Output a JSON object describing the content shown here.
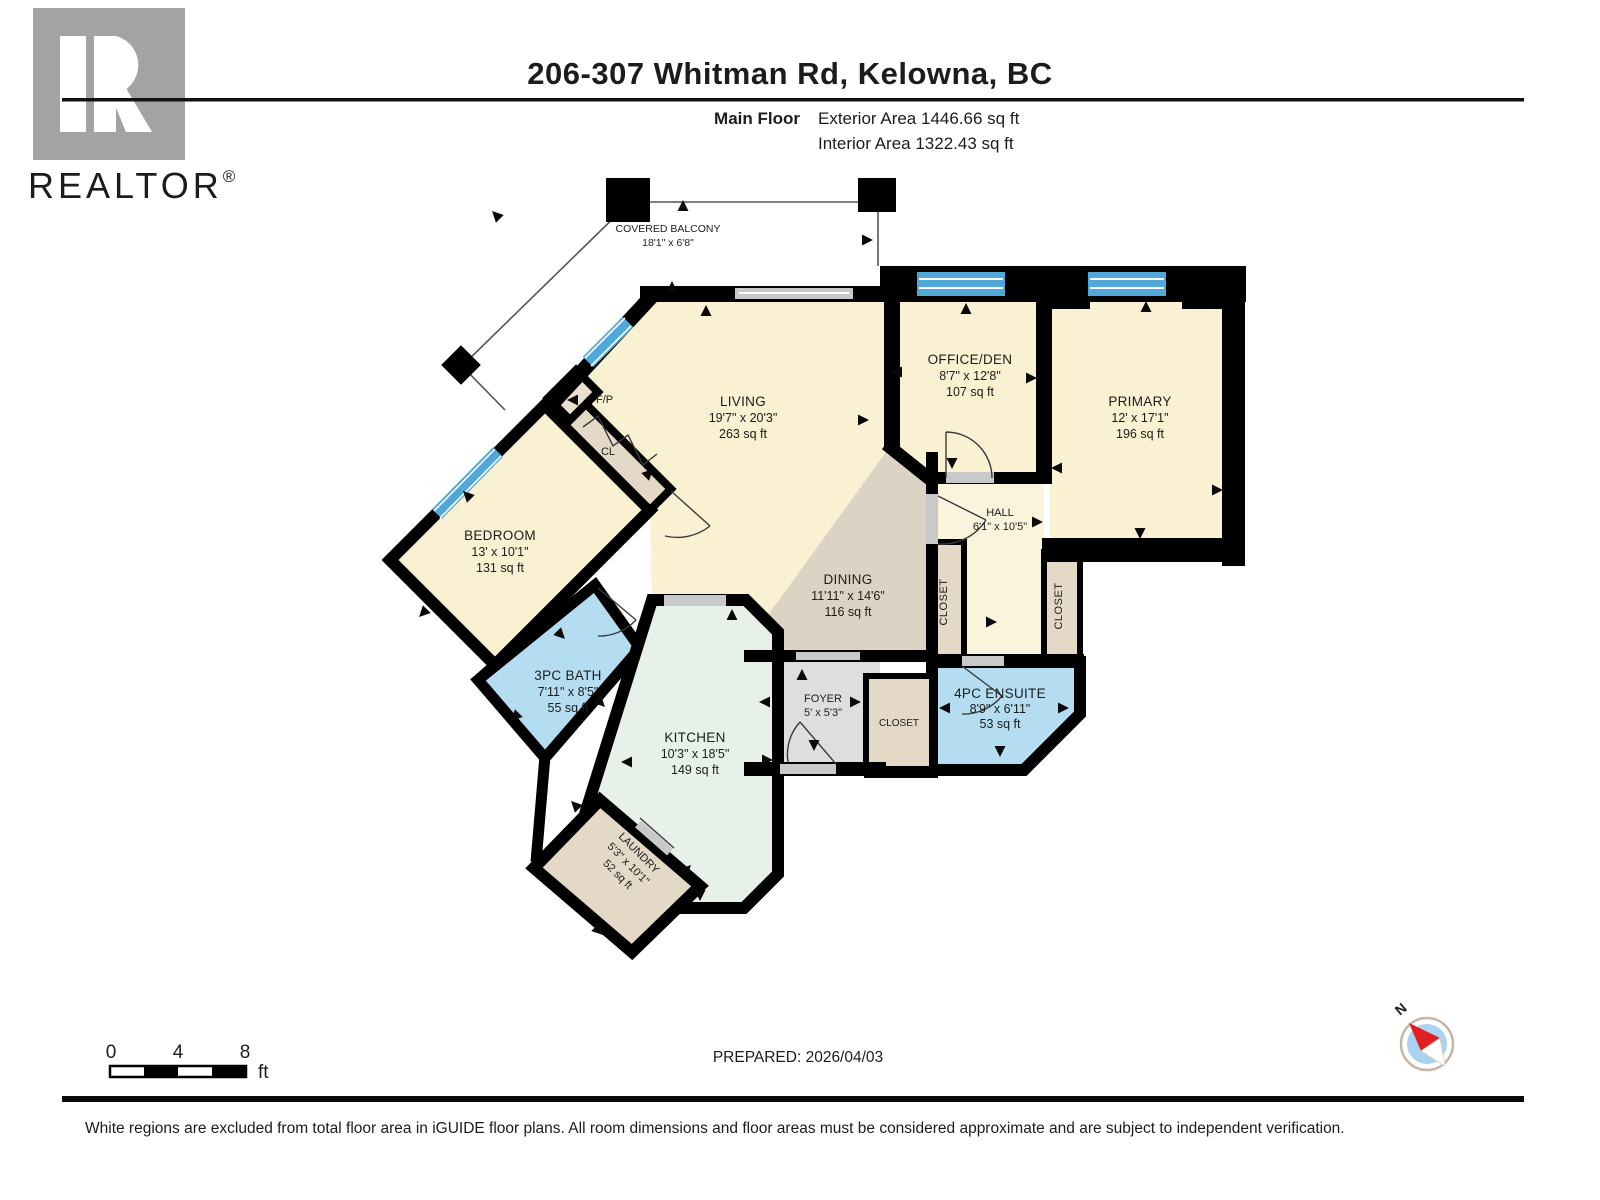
{
  "header": {
    "title": "206-307 Whitman Rd, Kelowna, BC",
    "floor_label": "Main Floor",
    "exterior_area": "Exterior Area 1446.66 sq ft",
    "interior_area": "Interior Area 1322.43 sq ft"
  },
  "branding": {
    "logo_letter": "R",
    "logo_word": "REALTOR",
    "registered_mark": "®"
  },
  "rooms": {
    "covered_balcony": {
      "name": "COVERED BALCONY",
      "dims": "18'1\" x 6'8\""
    },
    "living": {
      "name": "LIVING",
      "dims": "19'7\" x 20'3\"",
      "area": "263 sq ft"
    },
    "office_den": {
      "name": "OFFICE/DEN",
      "dims": "8'7\" x 12'8\"",
      "area": "107 sq ft"
    },
    "primary": {
      "name": "PRIMARY",
      "dims": "12' x 17'1\"",
      "area": "196 sq ft"
    },
    "bedroom": {
      "name": "BEDROOM",
      "dims": "13' x 10'1\"",
      "area": "131 sq ft"
    },
    "dining": {
      "name": "DINING",
      "dims": "11'11\" x 14'6\"",
      "area": "116 sq ft"
    },
    "kitchen": {
      "name": "KITCHEN",
      "dims": "10'3\" x 18'5\"",
      "area": "149 sq ft"
    },
    "bath_3pc": {
      "name": "3PC BATH",
      "dims": "7'11\" x 8'5\"",
      "area": "55 sq ft"
    },
    "ensuite_4pc": {
      "name": "4PC ENSUITE",
      "dims": "8'9\" x 6'11\"",
      "area": "53 sq ft"
    },
    "laundry": {
      "name": "LAUNDRY",
      "dims": "5'3\" x 10'1\"",
      "area": "52 sq ft"
    },
    "foyer": {
      "name": "FOYER",
      "dims": "5' x 5'3\""
    },
    "hall": {
      "name": "HALL",
      "dims": "6'1\" x 10'5\""
    },
    "closet_hall_left": {
      "name": "CLOSET"
    },
    "closet_hall_right": {
      "name": "CLOSET"
    },
    "closet_foyer": {
      "name": "CLOSET"
    },
    "closet_cl": {
      "name": "CL"
    },
    "fireplace": {
      "name": "F/P"
    }
  },
  "scale_bar": {
    "tick_0": "0",
    "tick_4": "4",
    "tick_8": "8",
    "unit": "ft"
  },
  "prepared_label": "PREPARED: 2026/04/03",
  "compass": {
    "north_label": "N"
  },
  "footer": {
    "disclaimer": "White regions are excluded from total floor area in iGUIDE floor plans. All room dimensions and floor areas must be considered approximate and are subject to independent verification."
  },
  "colors": {
    "wall": "#000000",
    "room_cream": "#FAF0D2",
    "hall_cream": "#FBF4DC",
    "dining_tan": "#DCD3C4",
    "kitchen_mint": "#E7F1EA",
    "bath_blue": "#B5DDF2",
    "closet_tan": "#E3D9C6",
    "fp_tan": "#E9E0CF",
    "foyer_gray": "#DEDEDC",
    "window_blue": "#4FA8D8",
    "opening_gray": "#C9C9C9",
    "logo_gray": "#A3A3A5",
    "compass_blue": "#A9D3EF",
    "compass_red": "#E02020"
  }
}
